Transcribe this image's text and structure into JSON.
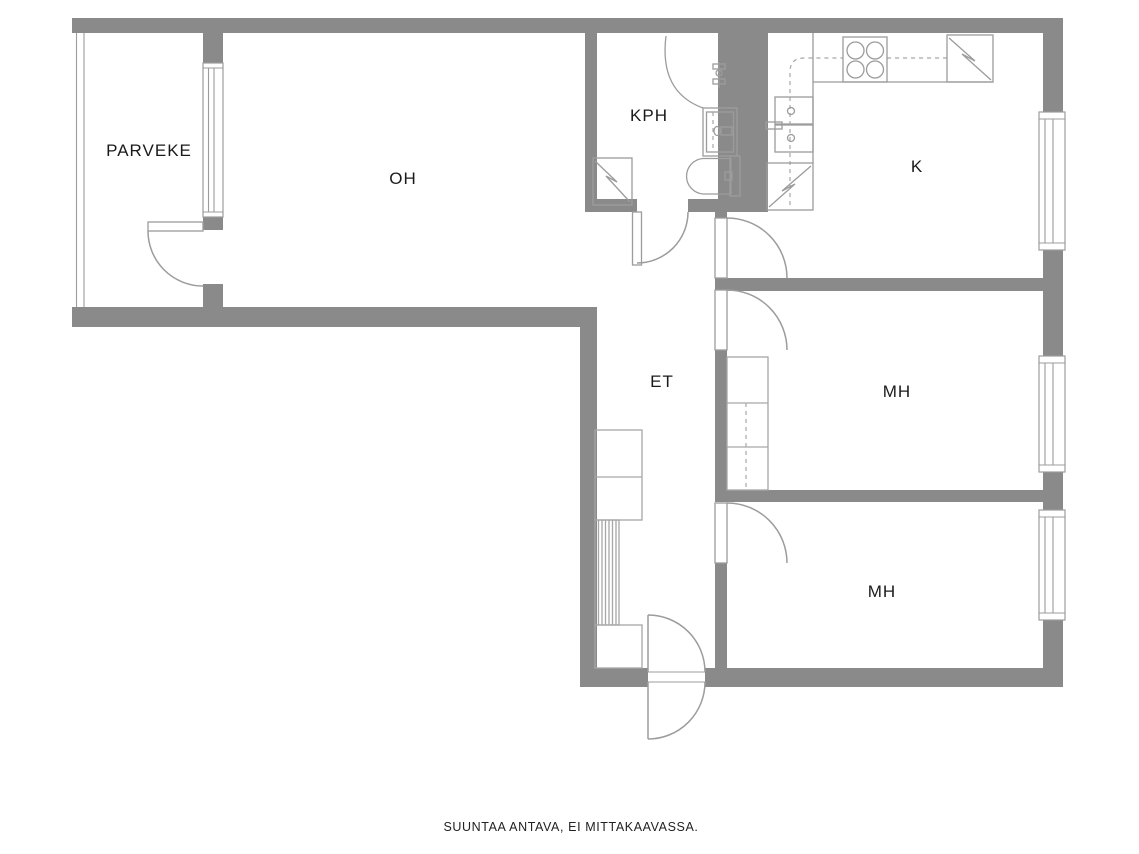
{
  "figure": {
    "type": "floor-plan",
    "footer_note": "SUUNTAA ANTAVA, EI MITTAKAAVASSA."
  },
  "palette": {
    "wall": "#8a8a8a",
    "line": "#9c9c9c",
    "furniture": "#a6a6a6",
    "text": "#1a1a1a",
    "background": "#ffffff"
  },
  "rooms": {
    "balcony": {
      "label": "PARVEKE"
    },
    "living": {
      "label": "OH"
    },
    "bathroom": {
      "label": "KPH"
    },
    "kitchen": {
      "label": "K"
    },
    "hallway": {
      "label": "ET"
    },
    "bedroom_1": {
      "label": "MH"
    },
    "bedroom_2": {
      "label": "MH"
    }
  },
  "icons": {
    "stove": "stove-icon",
    "fridge": "fridge-icon",
    "kitchen_sink": "sink-icon",
    "appliance_reservation": "appliance-reservation-icon",
    "shower": "shower-icon",
    "shower_faucet": "faucet-icon",
    "washbasin": "washbasin-icon",
    "toilet": "toilet-icon",
    "washing_machine_reservation": "appliance-reservation-icon",
    "wardrobe": "wardrobe-icon",
    "coat_rack": "coat-rack-icon",
    "window": "window-icon",
    "door": "door-swing-icon"
  }
}
